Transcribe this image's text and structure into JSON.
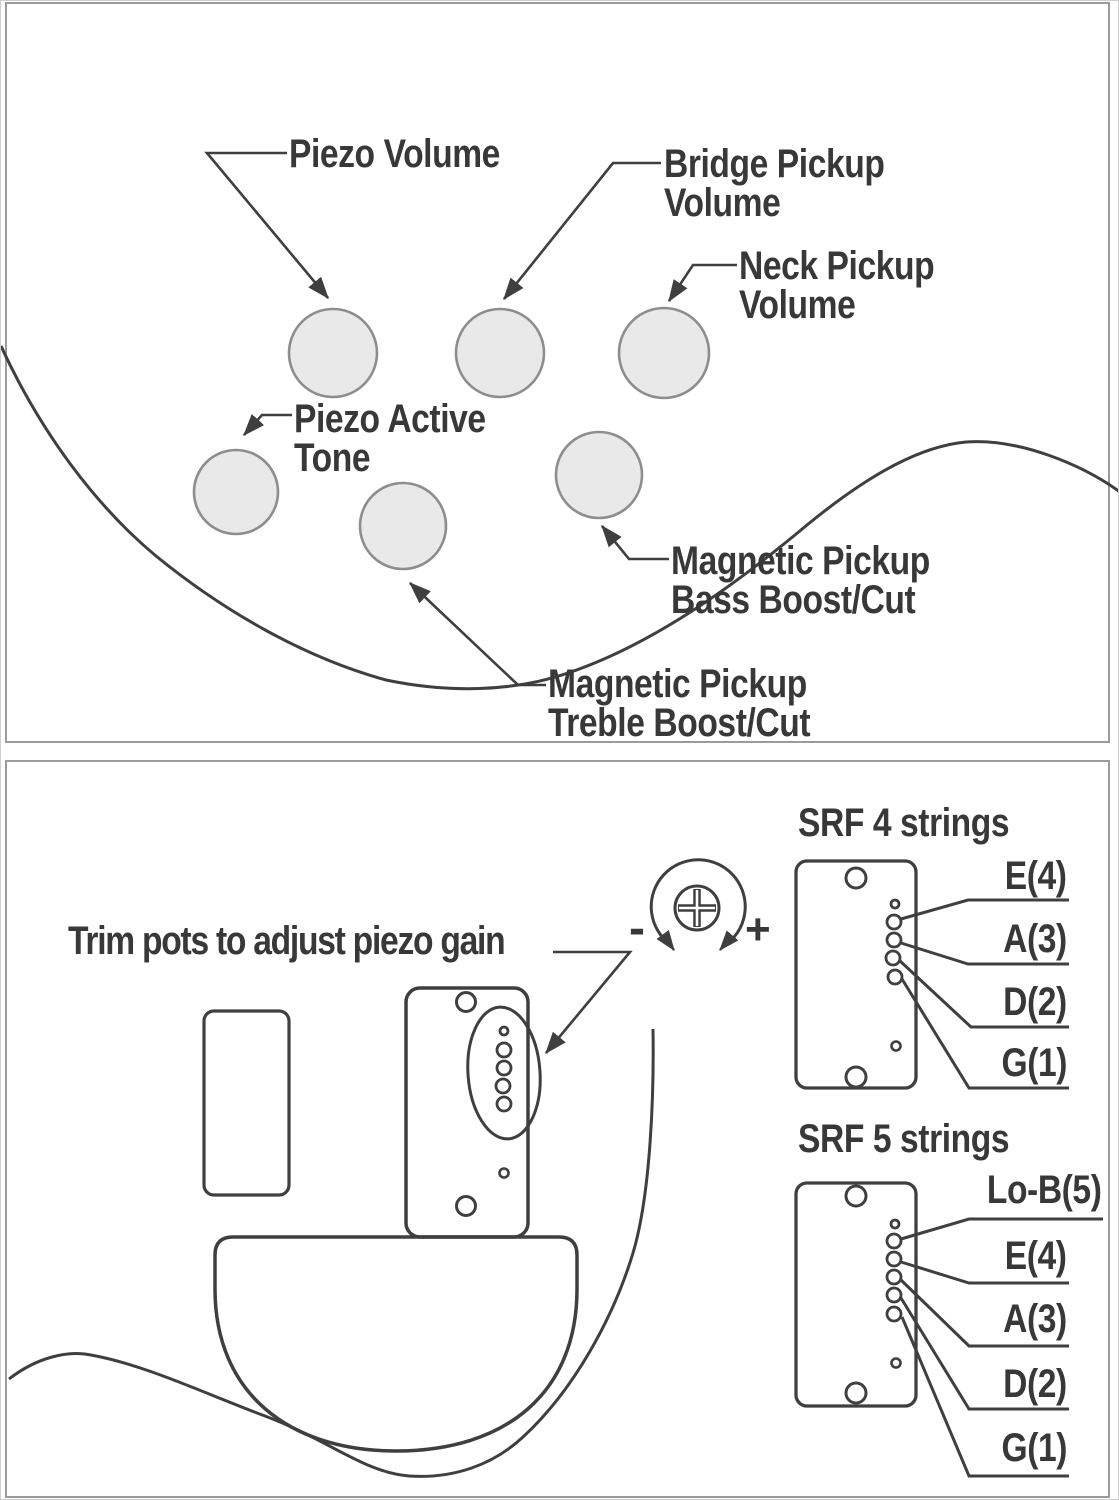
{
  "colors": {
    "background": "#ffffff",
    "panel_border": "#9b9b9b",
    "line_art": "#3f3f3f",
    "text": "#383838",
    "knob_fill": "#e9e9e9",
    "knob_stroke": "#8d8d8d"
  },
  "top_panel": {
    "labels": {
      "piezo_volume": "Piezo Volume",
      "bridge_pickup_volume": "Bridge Pickup\nVolume",
      "neck_pickup_volume": "Neck Pickup\nVolume",
      "piezo_active_tone": "Piezo Active\nTone",
      "magnetic_bass": "Magnetic Pickup\nBass Boost/Cut",
      "magnetic_treble": "Magnetic Pickup\nTreble Boost/Cut"
    }
  },
  "bottom_panel": {
    "trim_label": "Trim pots to adjust piezo gain",
    "minus_sign": "-",
    "plus_sign": "+",
    "srf4": {
      "title": "SRF 4 strings",
      "strings": [
        "E(4)",
        "A(3)",
        "D(2)",
        "G(1)"
      ]
    },
    "srf5": {
      "title": "SRF 5 strings",
      "strings": [
        "Lo-B(5)",
        "E(4)",
        "A(3)",
        "D(2)",
        "G(1)"
      ]
    }
  }
}
